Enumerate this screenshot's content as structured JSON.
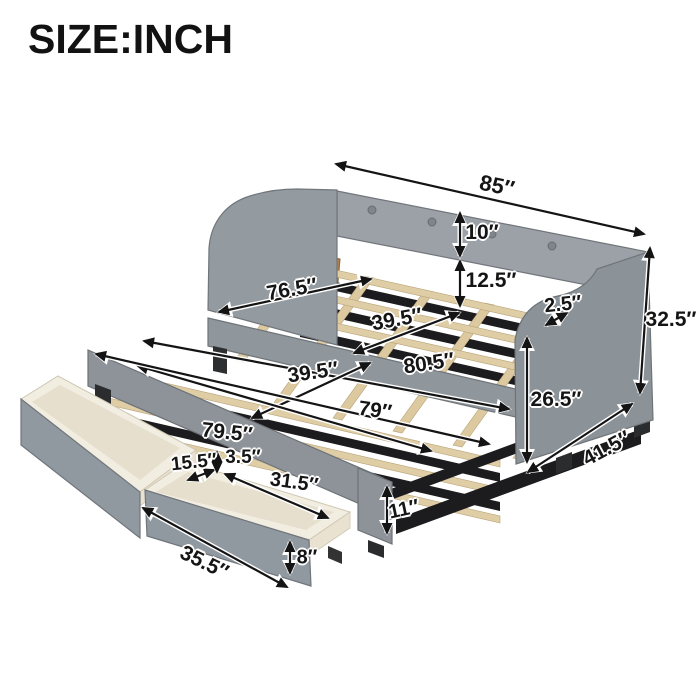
{
  "title": "SIZE:INCH",
  "unit": "inch",
  "dims": {
    "overall_length": {
      "text": "85″",
      "inches": 85
    },
    "back_height": {
      "text": "10″",
      "inches": 10
    },
    "back_to_slat": {
      "text": "12.5″",
      "inches": 12.5
    },
    "arm_top_thickness": {
      "text": "2.5″",
      "inches": 2.5
    },
    "overall_height": {
      "text": "32.5″",
      "inches": 32.5
    },
    "side_height": {
      "text": "26.5″",
      "inches": 26.5
    },
    "overall_depth": {
      "text": "41.5″",
      "inches": 41.5
    },
    "slat_area_length": {
      "text": "76.5″",
      "inches": 76.5
    },
    "upper_bed_width": {
      "text": "39.5″",
      "inches": 39.5
    },
    "trundle_length": {
      "text": "80.5″",
      "inches": 80.5
    },
    "trundle_width": {
      "text": "39.5″",
      "inches": 39.5
    },
    "upper_bed_length": {
      "text": "79″",
      "inches": 79
    },
    "trundle_frame_length": {
      "text": "79.5″",
      "inches": 79.5
    },
    "drawer_inner_width": {
      "text": "15.5″",
      "inches": 15.5
    },
    "drawer_rim_gap": {
      "text": "3.5″",
      "inches": 3.5
    },
    "drawer_inner_length": {
      "text": "31.5″",
      "inches": 31.5
    },
    "drawer_length": {
      "text": "35.5″",
      "inches": 35.5
    },
    "drawer_height": {
      "text": "8″",
      "inches": 8
    },
    "trundle_frame_height": {
      "text": "11″",
      "inches": 11
    }
  },
  "colors": {
    "background": "#ffffff",
    "text": "#151515",
    "fabric_gray": "#939aa0",
    "fabric_gray_dark": "#8b9298",
    "slat_wood": "#dfcda6",
    "frame_black": "#1c1c1e",
    "drawer_interior_cream": "#f2ede1",
    "arrow": "#141414"
  }
}
